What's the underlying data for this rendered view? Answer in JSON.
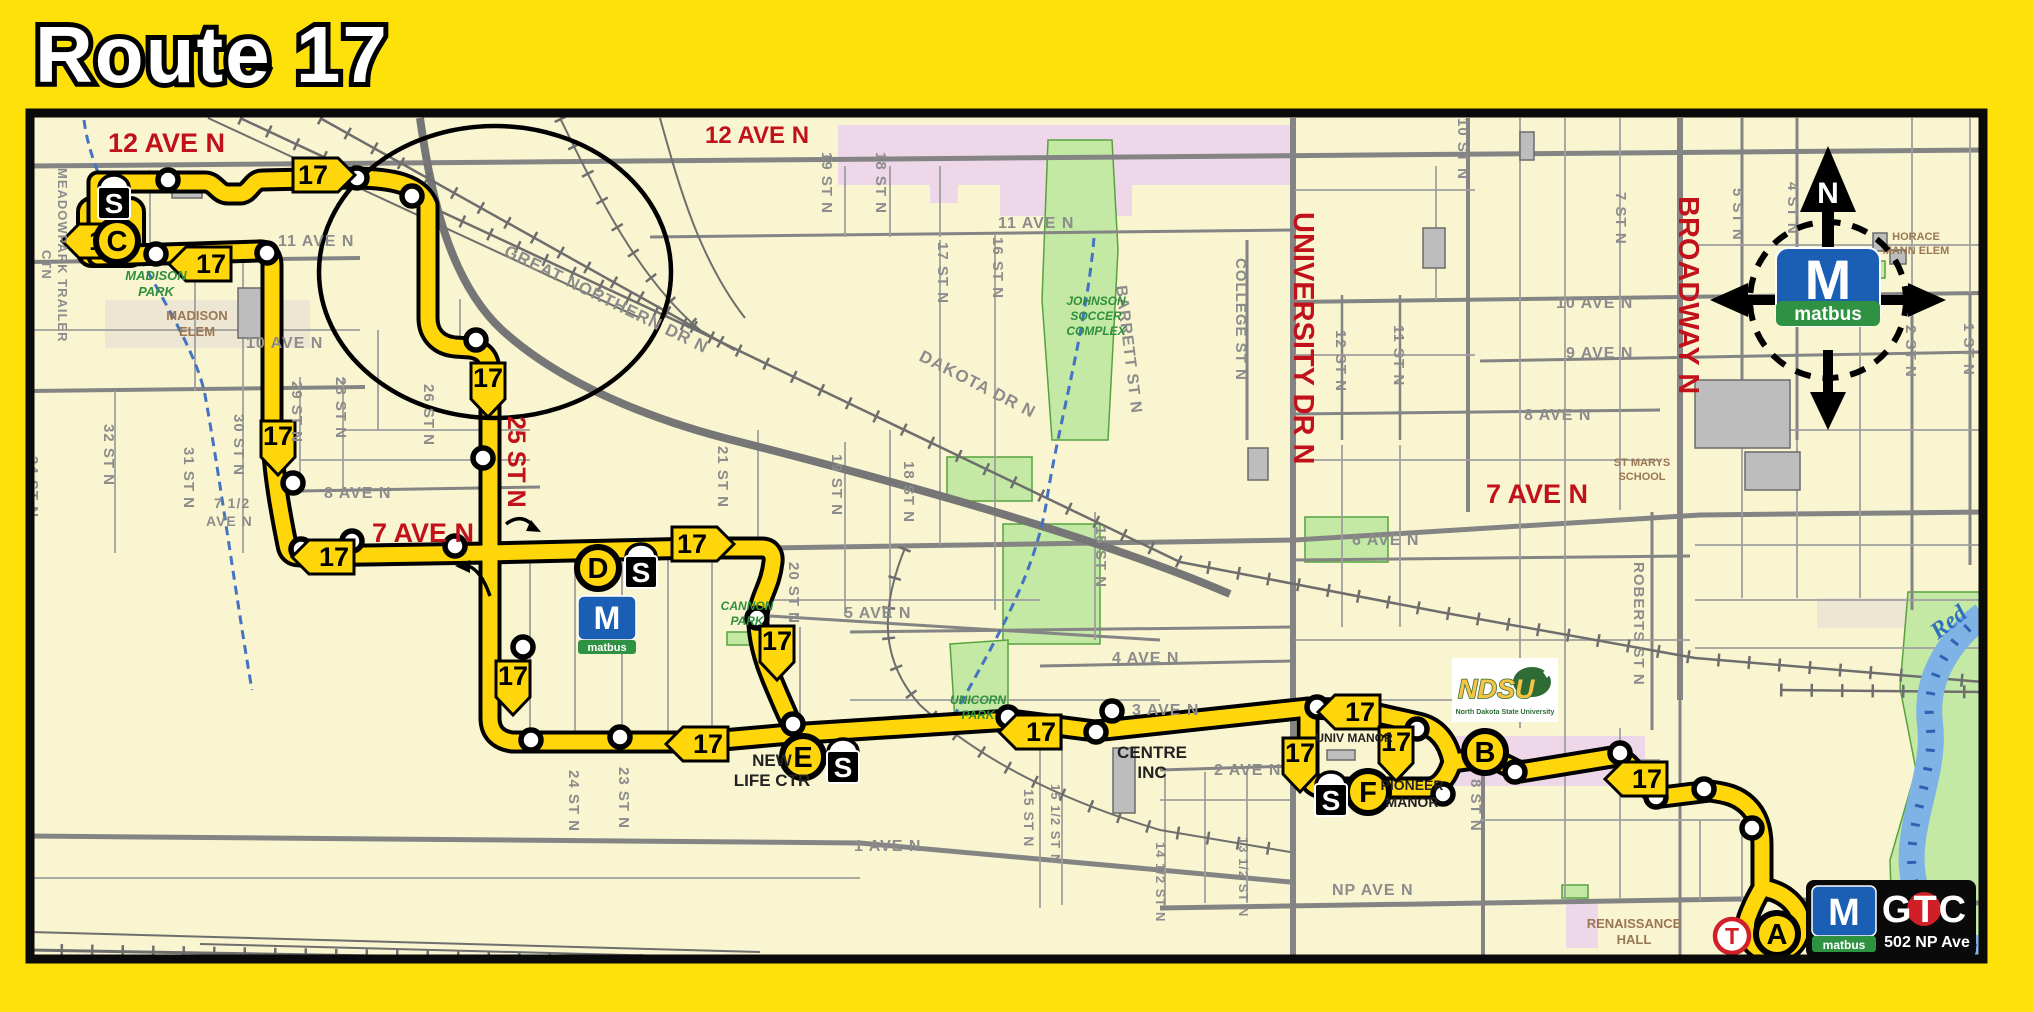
{
  "title": "Route 17",
  "badge_label": "17",
  "compass": {
    "north": "N"
  },
  "matbus_logo": {
    "m": "M",
    "name": "matbus"
  },
  "ndsu_logo": {
    "name": "NDSU",
    "full": "North Dakota State University"
  },
  "gtc_logo": {
    "m": "M",
    "sub": "matbus",
    "name": "GTC",
    "address": "502 NP Ave"
  },
  "map": {
    "street_labels": [
      {
        "t": "12 AVE N",
        "x": 108,
        "y": 152,
        "s": 27,
        "c": "red"
      },
      {
        "t": "12 AVE N",
        "x": 705,
        "y": 143,
        "s": 24,
        "c": "red"
      },
      {
        "t": "7 AVE N",
        "x": 372,
        "y": 542,
        "s": 27,
        "c": "red"
      },
      {
        "t": "7 AVE N",
        "x": 1486,
        "y": 503,
        "s": 27,
        "c": "red"
      },
      {
        "t": "25 ST N",
        "x": 508,
        "y": 416,
        "r": 90,
        "s": 25,
        "c": "red"
      },
      {
        "t": "UNIVERSITY DR N",
        "x": 1294,
        "y": 212,
        "r": 90,
        "s": 29,
        "c": "red"
      },
      {
        "t": "BROADWAY N",
        "x": 1679,
        "y": 196,
        "r": 90,
        "s": 29,
        "c": "red"
      },
      {
        "t": "MEADOWPARK TRAILER",
        "x": 58,
        "y": 168,
        "r": 90,
        "s": 13,
        "c": "st"
      },
      {
        "t": "CTN",
        "x": 42,
        "y": 250,
        "r": 90,
        "s": 13,
        "c": "st"
      },
      {
        "t": "34 ST N",
        "x": 28,
        "y": 456,
        "r": 90,
        "s": 15,
        "c": "st"
      },
      {
        "t": "32 ST N",
        "x": 104,
        "y": 424,
        "r": 90,
        "s": 15,
        "c": "st"
      },
      {
        "t": "31 ST N",
        "x": 184,
        "y": 447,
        "r": 90,
        "s": 15,
        "c": "st"
      },
      {
        "t": "30 ST N",
        "x": 234,
        "y": 414,
        "r": 90,
        "s": 15,
        "c": "st"
      },
      {
        "t": "29 ST N",
        "x": 292,
        "y": 381,
        "r": 90,
        "s": 15,
        "c": "st"
      },
      {
        "t": "28 ST N",
        "x": 336,
        "y": 377,
        "r": 90,
        "s": 15,
        "c": "st"
      },
      {
        "t": "26 ST N",
        "x": 424,
        "y": 384,
        "r": 90,
        "s": 15,
        "c": "st"
      },
      {
        "t": "24 ST N",
        "x": 569,
        "y": 770,
        "r": 90,
        "s": 15,
        "c": "st"
      },
      {
        "t": "23 ST N",
        "x": 619,
        "y": 767,
        "r": 90,
        "s": 15,
        "c": "st"
      },
      {
        "t": "21 ST N",
        "x": 718,
        "y": 446,
        "r": 90,
        "s": 15,
        "c": "st"
      },
      {
        "t": "20 ST N",
        "x": 789,
        "y": 562,
        "r": 90,
        "s": 15,
        "c": "st"
      },
      {
        "t": "19 ST N",
        "x": 822,
        "y": 152,
        "r": 90,
        "s": 15,
        "c": "st"
      },
      {
        "t": "18 ST N",
        "x": 876,
        "y": 152,
        "r": 90,
        "s": 15,
        "c": "st"
      },
      {
        "t": "19 ST N",
        "x": 832,
        "y": 454,
        "r": 90,
        "s": 15,
        "c": "st"
      },
      {
        "t": "18 ST N",
        "x": 904,
        "y": 461,
        "r": 90,
        "s": 15,
        "c": "st"
      },
      {
        "t": "17 ST N",
        "x": 938,
        "y": 242,
        "r": 90,
        "s": 15,
        "c": "st"
      },
      {
        "t": "16 ST N",
        "x": 993,
        "y": 237,
        "r": 90,
        "s": 15,
        "c": "st"
      },
      {
        "t": "15 ST N",
        "x": 1096,
        "y": 526,
        "r": 90,
        "s": 15,
        "c": "st"
      },
      {
        "t": "15 ST N",
        "x": 1024,
        "y": 789,
        "r": 90,
        "s": 14,
        "c": "st"
      },
      {
        "t": "15 1/2 ST N",
        "x": 1051,
        "y": 784,
        "r": 90,
        "s": 13,
        "c": "st"
      },
      {
        "t": "14 1/2 ST N",
        "x": 1156,
        "y": 842,
        "r": 90,
        "s": 13,
        "c": "st"
      },
      {
        "t": "13 1/2 ST N",
        "x": 1239,
        "y": 837,
        "r": 90,
        "s": 13,
        "c": "st"
      },
      {
        "t": "8 ST N",
        "x": 1471,
        "y": 779,
        "r": 90,
        "s": 15,
        "c": "st"
      },
      {
        "t": "COLLEGE ST N",
        "x": 1236,
        "y": 258,
        "r": 90,
        "s": 15,
        "c": "st"
      },
      {
        "t": "BARRETT ST N",
        "x": 1116,
        "y": 286,
        "r": 83,
        "s": 16,
        "c": "st"
      },
      {
        "t": "12 ST N",
        "x": 1336,
        "y": 330,
        "r": 90,
        "s": 15,
        "c": "st"
      },
      {
        "t": "11 ST N",
        "x": 1394,
        "y": 325,
        "r": 90,
        "s": 15,
        "c": "st"
      },
      {
        "t": "10 ST N",
        "x": 1458,
        "y": 118,
        "r": 90,
        "s": 15,
        "c": "st"
      },
      {
        "t": "7 ST N",
        "x": 1616,
        "y": 192,
        "r": 90,
        "s": 15,
        "c": "st"
      },
      {
        "t": "5 ST N",
        "x": 1733,
        "y": 188,
        "r": 90,
        "s": 15,
        "c": "st"
      },
      {
        "t": "4 ST N",
        "x": 1788,
        "y": 182,
        "r": 90,
        "s": 15,
        "c": "st"
      },
      {
        "t": "2 ST N",
        "x": 1906,
        "y": 325,
        "r": 90,
        "s": 15,
        "c": "st"
      },
      {
        "t": "1 ST N",
        "x": 1964,
        "y": 323,
        "r": 90,
        "s": 15,
        "c": "st"
      },
      {
        "t": "ROBERTS ST N",
        "x": 1634,
        "y": 562,
        "r": 90,
        "s": 15,
        "c": "st"
      },
      {
        "t": "11 AVE N",
        "x": 278,
        "y": 246,
        "s": 16,
        "c": "st"
      },
      {
        "t": "11 AVE N",
        "x": 998,
        "y": 228,
        "s": 16,
        "c": "st"
      },
      {
        "t": "10 AVE N",
        "x": 246,
        "y": 348,
        "s": 16,
        "c": "st"
      },
      {
        "t": "10 AVE N",
        "x": 1556,
        "y": 308,
        "s": 16,
        "c": "st"
      },
      {
        "t": "9 AVE N",
        "x": 1566,
        "y": 358,
        "s": 16,
        "c": "st"
      },
      {
        "t": "8 AVE N",
        "x": 324,
        "y": 498,
        "s": 16,
        "c": "st"
      },
      {
        "t": "8 AVE N",
        "x": 1524,
        "y": 420,
        "s": 16,
        "c": "st"
      },
      {
        "t": "7 1/2",
        "x": 214,
        "y": 508,
        "s": 14,
        "c": "st"
      },
      {
        "t": "AVE N",
        "x": 206,
        "y": 526,
        "s": 14,
        "c": "st"
      },
      {
        "t": "6 AVE N",
        "x": 1352,
        "y": 545,
        "s": 16,
        "c": "st"
      },
      {
        "t": "5 AVE N",
        "x": 844,
        "y": 618,
        "s": 16,
        "c": "st"
      },
      {
        "t": "4 AVE N",
        "x": 1112,
        "y": 663,
        "s": 16,
        "c": "st"
      },
      {
        "t": "3 AVE N",
        "x": 1132,
        "y": 715,
        "s": 16,
        "c": "st"
      },
      {
        "t": "2 AVE N",
        "x": 1214,
        "y": 775,
        "s": 16,
        "c": "st"
      },
      {
        "t": "1 AVE N",
        "x": 854,
        "y": 851,
        "s": 16,
        "c": "st"
      },
      {
        "t": "NP AVE N",
        "x": 1332,
        "y": 895,
        "s": 16,
        "c": "st"
      },
      {
        "t": "GREAT NORTHERN DR N",
        "x": 503,
        "y": 255,
        "r": 26,
        "s": 17,
        "c": "st"
      },
      {
        "t": "DAKOTA DR N",
        "x": 918,
        "y": 360,
        "r": 27,
        "s": 17,
        "c": "st"
      },
      {
        "t": "Red",
        "x": 1938,
        "y": 640,
        "r": -38,
        "s": 24,
        "c": "blue"
      }
    ],
    "place_labels": [
      {
        "lines": [
          "MADISON",
          "PARK"
        ],
        "x": 156,
        "y": 280,
        "c": "green",
        "s": 13
      },
      {
        "lines": [
          "MADISON",
          "ELEM"
        ],
        "x": 197,
        "y": 320,
        "c": "brown",
        "s": 13
      },
      {
        "lines": [
          "JOHNSON",
          "SOCCER",
          "COMPLEX"
        ],
        "x": 1096,
        "y": 305,
        "c": "green",
        "s": 12
      },
      {
        "lines": [
          "CANNON",
          "PARK"
        ],
        "x": 747,
        "y": 610,
        "c": "green",
        "s": 12
      },
      {
        "lines": [
          "UNICORN",
          "PARK"
        ],
        "x": 978,
        "y": 704,
        "c": "green",
        "s": 12
      },
      {
        "lines": [
          "NEW",
          "LIFE CTR"
        ],
        "x": 772,
        "y": 766,
        "c": "dark",
        "s": 17
      },
      {
        "lines": [
          "CENTRE",
          "INC"
        ],
        "x": 1152,
        "y": 758,
        "c": "dark",
        "s": 17
      },
      {
        "lines": [
          "UNIV MANOR"
        ],
        "x": 1354,
        "y": 742,
        "c": "dark",
        "s": 12
      },
      {
        "lines": [
          "PIONEER",
          "MANOR"
        ],
        "x": 1412,
        "y": 790,
        "c": "dark",
        "s": 14
      },
      {
        "lines": [
          "RENAISSANCE",
          "HALL"
        ],
        "x": 1634,
        "y": 928,
        "c": "brown",
        "s": 13
      },
      {
        "lines": [
          "HORACE",
          "MANN ELEM"
        ],
        "x": 1916,
        "y": 240,
        "c": "brown",
        "s": 11
      },
      {
        "lines": [
          "ST MARYS",
          "SCHOOL"
        ],
        "x": 1642,
        "y": 466,
        "c": "brown",
        "s": 11
      }
    ],
    "stops": [
      [
        168,
        180
      ],
      [
        357,
        178
      ],
      [
        412,
        196
      ],
      [
        476,
        340
      ],
      [
        483,
        458
      ],
      [
        523,
        647
      ],
      [
        531,
        740
      ],
      [
        156,
        254
      ],
      [
        267,
        253
      ],
      [
        293,
        483
      ],
      [
        301,
        549
      ],
      [
        352,
        541
      ],
      [
        455,
        546
      ],
      [
        694,
        545
      ],
      [
        757,
        618
      ],
      [
        793,
        724
      ],
      [
        620,
        737
      ],
      [
        1008,
        717
      ],
      [
        1096,
        732
      ],
      [
        1112,
        711
      ],
      [
        1317,
        707
      ],
      [
        1417,
        729
      ],
      [
        1443,
        794
      ],
      [
        1515,
        772
      ],
      [
        1620,
        753
      ],
      [
        1656,
        797
      ],
      [
        1704,
        789
      ],
      [
        1752,
        828
      ]
    ],
    "stations": [
      {
        "letter": "C",
        "x": 117,
        "y": 241,
        "variant": "yellow"
      },
      {
        "letter": "D",
        "x": 598,
        "y": 568,
        "variant": "yellow"
      },
      {
        "letter": "E",
        "x": 803,
        "y": 757,
        "variant": "yellow"
      },
      {
        "letter": "B",
        "x": 1485,
        "y": 752,
        "variant": "yellow"
      },
      {
        "letter": "F",
        "x": 1368,
        "y": 792,
        "variant": "yellow"
      },
      {
        "letter": "A",
        "x": 1777,
        "y": 934,
        "variant": "yellow"
      },
      {
        "letter": "T",
        "x": 1732,
        "y": 936,
        "variant": "red"
      }
    ],
    "shelters": [
      [
        114,
        200
      ],
      [
        641,
        569
      ],
      [
        843,
        764
      ],
      [
        1331,
        797
      ]
    ],
    "shelter_letter": "S",
    "badges": [
      {
        "x": 100,
        "y": 241,
        "dir": "left"
      },
      {
        "x": 207,
        "y": 264,
        "dir": "left"
      },
      {
        "x": 317,
        "y": 175,
        "dir": "right"
      },
      {
        "x": 278,
        "y": 438,
        "dir": "down"
      },
      {
        "x": 488,
        "y": 380,
        "dir": "down"
      },
      {
        "x": 330,
        "y": 557,
        "dir": "left"
      },
      {
        "x": 696,
        "y": 544,
        "dir": "right"
      },
      {
        "x": 513,
        "y": 678,
        "dir": "down"
      },
      {
        "x": 777,
        "y": 643,
        "dir": "down"
      },
      {
        "x": 704,
        "y": 744,
        "dir": "left"
      },
      {
        "x": 1037,
        "y": 732,
        "dir": "left"
      },
      {
        "x": 1300,
        "y": 755,
        "dir": "down"
      },
      {
        "x": 1356,
        "y": 712,
        "dir": "left"
      },
      {
        "x": 1396,
        "y": 744,
        "dir": "down"
      },
      {
        "x": 1643,
        "y": 779,
        "dir": "left"
      }
    ],
    "colors": {
      "frame_yellow": "#FFE10A",
      "map_bg": "#F9F5D0",
      "route_yellow": "#FFD60A",
      "red_label": "#C1121C",
      "matbus_blue": "#1B5FB4",
      "matbus_green": "#2F9242",
      "gtc_red": "#D01F26"
    }
  }
}
